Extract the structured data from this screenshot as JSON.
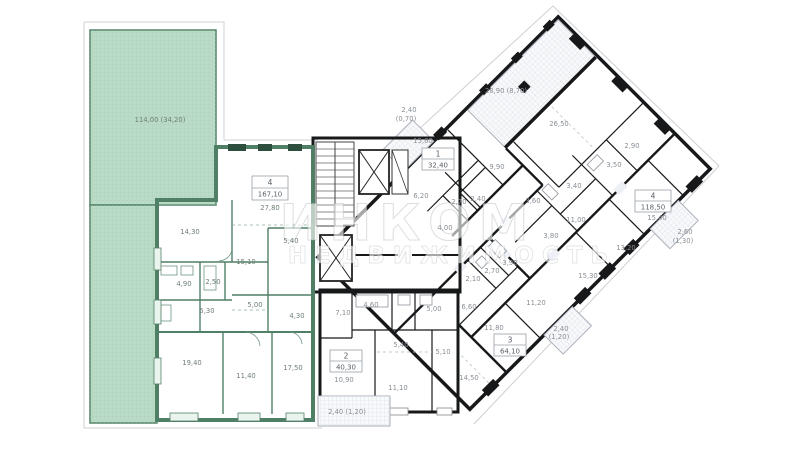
{
  "watermark": {
    "line1": "ИНКОМ",
    "line2": "НЕДВИЖИМОСТЬ"
  },
  "colors": {
    "green_apartment_fill": "#c8e2d2",
    "green_wall": "#4f7f65",
    "green_terrace_fill": "#badcc7",
    "wing_fill": "#edf0f6",
    "white_apartment_fill": "#fcfcfd",
    "wall": "#17181a",
    "hatch_line": "#ccd2dc",
    "label_text": "#8a9096"
  },
  "apartments": {
    "a167": {
      "number": "4",
      "area": "167,10",
      "terrace": "114,00 (34,20)",
      "rooms": [
        "27,80",
        "5,40",
        "14,30",
        "15,10",
        "4,90",
        "2,50",
        "5,30",
        "5,00",
        "4,30",
        "19,40",
        "11,40",
        "17,50"
      ]
    },
    "a32": {
      "number": "1",
      "area": "32,40",
      "balcony_line1": "2,40",
      "balcony_line2": "(0,70)",
      "rooms": [
        "15,60",
        "6,20",
        "2,70",
        "2,40",
        "4,00"
      ]
    },
    "a40": {
      "number": "2",
      "area": "40,30",
      "balcony": "2,40 (1,20)",
      "rooms": [
        "7,10",
        "4,60",
        "5,00",
        "5,40",
        "5,10",
        "10,90",
        "11,10"
      ]
    },
    "a64": {
      "number": "3",
      "area": "64,10",
      "balcony_line1": "2,40",
      "balcony_line2": "(1,20)",
      "rooms": [
        "6,60",
        "11,80",
        "11,20",
        "14,50",
        "3,90",
        "2,70",
        "2,10"
      ]
    },
    "a118": {
      "number": "4",
      "area": "118,50",
      "terrace": "28,90 (8,70)",
      "balcony_line1": "2,60",
      "balcony_line2": "(1,30)",
      "rooms": [
        "26,50",
        "9,90",
        "2,90",
        "3,50",
        "3,40",
        "3,60",
        "3,80",
        "11,00",
        "15,40",
        "13,20",
        "15,30"
      ]
    }
  }
}
